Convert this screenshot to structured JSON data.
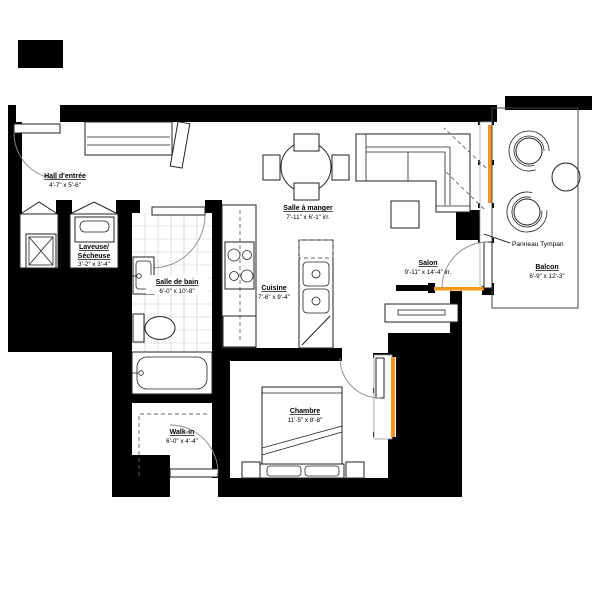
{
  "plan": {
    "rooms": [
      {
        "id": "hall",
        "name": "Hall d'entrée",
        "dims": "4'-7\" x 5'-6\""
      },
      {
        "id": "laundry",
        "name_line1": "Laveuse/",
        "name_line2": "Sécheuse",
        "dims": "3'-2\" x 3'-4\""
      },
      {
        "id": "bath",
        "name": "Salle de bain",
        "dims": "6'-0\" x 10'-8\""
      },
      {
        "id": "dining",
        "name": "Salle à manger",
        "dims": "7'-11\" x 6'-1\" irr."
      },
      {
        "id": "kitchen",
        "name": "Cuisine",
        "dims": "7'-6\" x 9'-4\""
      },
      {
        "id": "salon",
        "name": "Salon",
        "dims": "9'-11\" x 14'-4\" irr."
      },
      {
        "id": "balcony",
        "name": "Balcon",
        "dims": "6'-9\" x 12'-3\""
      },
      {
        "id": "bedroom",
        "name": "Chambre",
        "dims": "11'-5\" x 8'-8\""
      },
      {
        "id": "walkin",
        "name": "Walk-in",
        "dims": "6'-0\" x 4'-4\""
      }
    ],
    "annotations": [
      {
        "id": "panneau",
        "text": "Panneau Tympan"
      }
    ],
    "colors": {
      "wall": "#000000",
      "window_accent": "#f7941d",
      "tile_grid": "#c9c9c9"
    }
  }
}
